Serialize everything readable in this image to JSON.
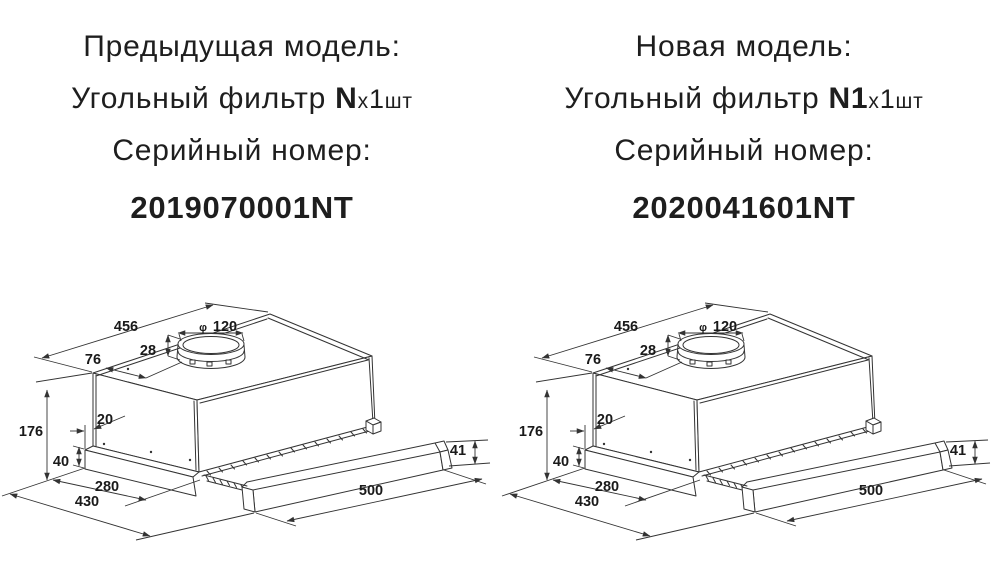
{
  "page": {
    "background": "#ffffff",
    "text_color": "#1e1e1e",
    "line_color": "#333333"
  },
  "columns": [
    {
      "title": "Предыдущая модель:",
      "filter_prefix": "Угольный фильтр",
      "filter_model": "N",
      "qty_x": "х",
      "qty_n": "1",
      "qty_unit": "шт",
      "serial_label": "Серийный номер:",
      "serial": "2019070001NT"
    },
    {
      "title": "Новая модель:",
      "filter_prefix": "Угольный фильтр",
      "filter_model": "N1",
      "qty_x": "х",
      "qty_n": "1",
      "qty_unit": "шт",
      "serial_label": "Серийный номер:",
      "serial": "2020041601NT"
    }
  ],
  "drawing": {
    "description": "isometric line drawing of telescopic cooker hood, shown twice",
    "dims": {
      "width_top": "456",
      "duct_dia_sym": "φ",
      "duct_dia": "120",
      "duct_offset_v": "28",
      "duct_offset_h": "76",
      "height_total": "176",
      "side_overhang": "20",
      "visor_height_left": "40",
      "depth_body": "280",
      "depth_total": "430",
      "visor_width": "500",
      "visor_height_right": "41"
    }
  }
}
